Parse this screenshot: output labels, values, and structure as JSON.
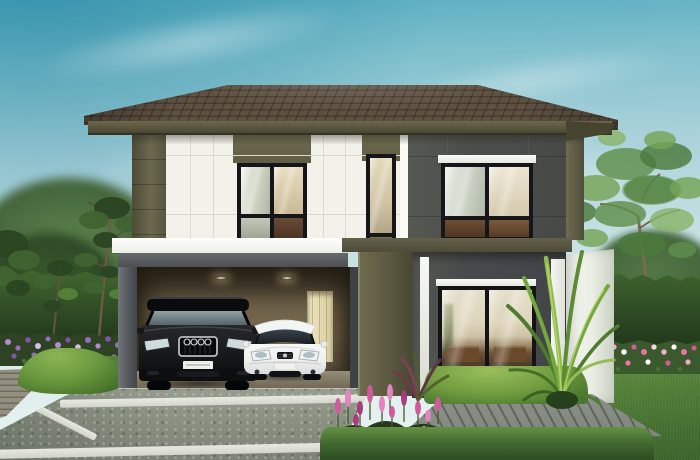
{
  "meta": {
    "title": "Two-storey modern house exterior rendering",
    "type": "architectural rendering, daytime",
    "description": "Modern two-storey house with dark hip roof, white and dark grey facade, open carport with two parked cars, glass sliding door, white garden wall, hedges, flower beds, trees and a concrete driveway"
  },
  "palette": {
    "sky_top": "#57acc0",
    "sky_horizon": "#e9f3f1",
    "roof_tile": "#4a3e32",
    "fascia_olive": "#56533d",
    "wall_white": "#f2f2eb",
    "wall_olive": "#6e6b4e",
    "wall_dark_upper": "#4b4d49",
    "wall_dark_lower": "#474a4b",
    "carport_interior": "#6e6148",
    "carport_side_door": "#e9dfb8",
    "window_frame": "#15151a",
    "trim_white": "#f8f9f5",
    "garden_wall": "#e9ede3",
    "hedge_dark": "#2c4823",
    "hedge_light": "#8cb455",
    "grass": "#4f7c36",
    "driveway": "#8f968a",
    "joint_strip": "#eef0e8",
    "deck_grey": "#8d9289",
    "flower_purple": "#9a6cc0",
    "flower_pink": "#e873a6",
    "flower_magenta": "#cf5a9e",
    "suv_black": "#0b0c0d",
    "hatchback_white": "#f3f5f4"
  },
  "scene": {
    "sky": {
      "label": "pale blue sky with soft diagonal clouds",
      "clouds": 4
    },
    "roof": {
      "label": "hip roof with dark brown concrete tiles and olive fascia"
    },
    "upper_floor": {
      "label": "second storey: white panelled left section, dark grey right section, olive accents",
      "windows": [
        {
          "id": "upper-left-window",
          "style": "black frame, 2x2 panes"
        },
        {
          "id": "upper-narrow-window",
          "style": "black frame, tall narrow"
        },
        {
          "id": "upper-right-window",
          "style": "black frame, 2x2 panes, white header strip"
        }
      ]
    },
    "ground_floor": {
      "carport": {
        "label": "open double carport with recessed ceiling lights and cream side door",
        "lights": 2
      },
      "sliding_door": {
        "label": "black framed glass sliding door, 2 panels, warm interior visible",
        "panels": 2
      },
      "garden_wall": {
        "label": "white rendered garden wall at right"
      }
    },
    "vehicles": [
      {
        "id": "black-suv",
        "label": "black luxury SUV parked in carport, chrome grille with four-ring emblem"
      },
      {
        "id": "white-hatchback",
        "label": "white compact hatchback parked in carport"
      }
    ],
    "landscape": {
      "left": {
        "trees": 2,
        "hedge": "tall clipped hedge",
        "flower_bed": "purple lavender-like bed",
        "mound": "round clipped shrub",
        "deck": "grey timber deck corner"
      },
      "right": {
        "trees": 1,
        "hedge": "tall clipped hedge",
        "flower_bed": "pink and white bedding flowers",
        "plant": "green dracaena with arching leaves",
        "accent_plant": "dark red cordyline"
      },
      "center": {
        "flower_cluster": "magenta flower spikes",
        "front_hedges": 2
      },
      "driveway": {
        "label": "mottled concrete driveway",
        "joint_strips": 3
      },
      "deck_right": {
        "label": "grey timber deck with diagonal planks"
      },
      "lawn": {
        "label": "green lawn at right"
      }
    }
  }
}
